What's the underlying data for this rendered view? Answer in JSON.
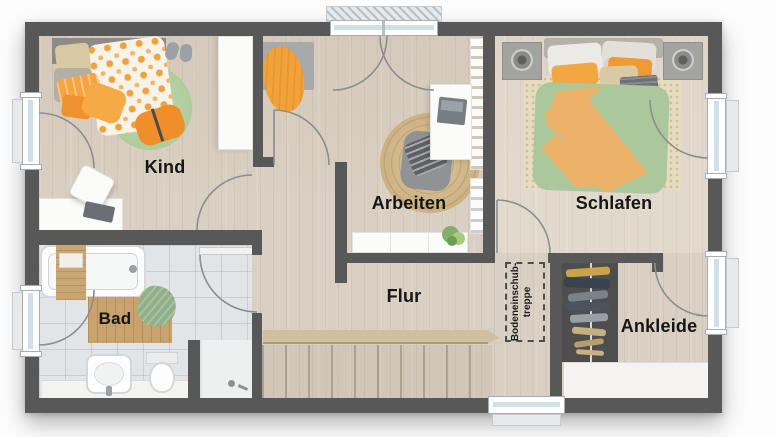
{
  "rooms": {
    "kind": {
      "label": "Kind"
    },
    "arbeiten": {
      "label": "Arbeiten"
    },
    "schlafen": {
      "label": "Schlafen"
    },
    "flur": {
      "label": "Flur"
    },
    "bad": {
      "label": "Bad"
    },
    "ankleide": {
      "label": "Ankleide"
    }
  },
  "annotations": {
    "loft_hatch": {
      "line1": "Bodeneinschub-",
      "line2": "treppe"
    }
  },
  "palette": {
    "wall": "#585858",
    "wood_floor": "#d9cfc2",
    "tile_floor": "#e2e5e7",
    "accent_orange": "#f2a440",
    "kids_rug_green": "#b5d2a0",
    "bed_duvet_green": "#abc79c",
    "bed_duvet_orange": "#ecb168",
    "jute_rug": "#d3bd92",
    "label_text": "#161616",
    "window_glass": "#cfe0ea"
  }
}
